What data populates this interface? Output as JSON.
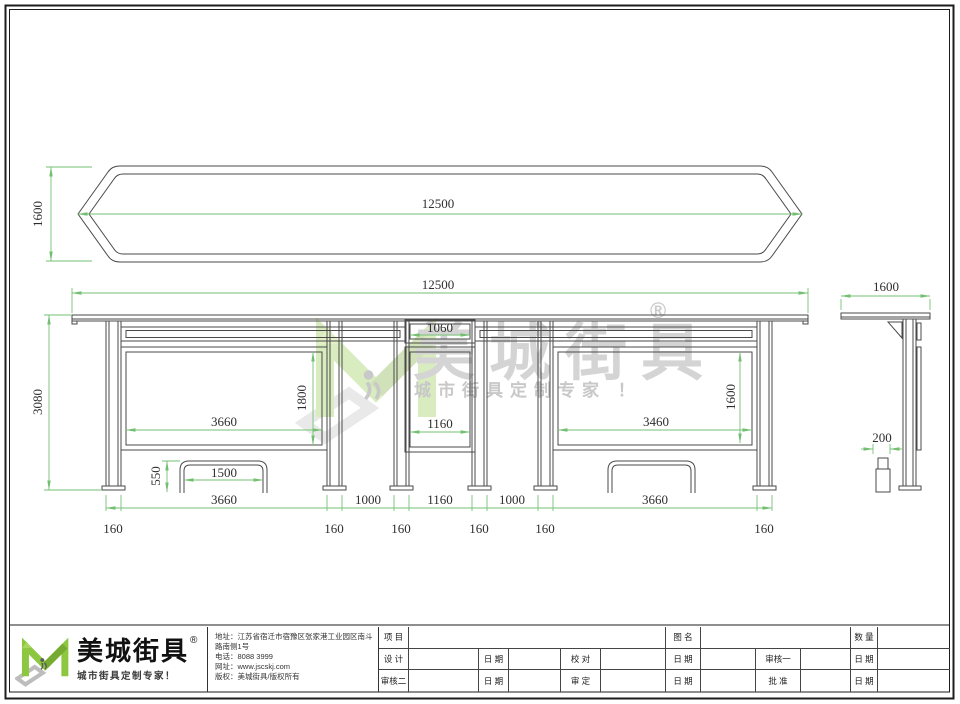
{
  "watermark": {
    "brand": "美城街具",
    "registered": "®",
    "tagline": "城市街具定制专家 ！"
  },
  "dims": {
    "overall_length": "12500",
    "overall_depth": "1600",
    "overall_height": "3080",
    "left_panel_width": "3660",
    "left_panel_height": "1800",
    "right_panel_width": "3460",
    "right_panel_height": "1600",
    "sign_header_width": "1060",
    "sign_panel_width": "1160",
    "bench_width": "1500",
    "bench_height": "550",
    "bay_gap": "1000",
    "column_width": "160",
    "bin_width": "200"
  },
  "title_block": {
    "logo": {
      "brand": "美城街具",
      "registered": "®",
      "tagline": "城市街具定制专家！"
    },
    "info": [
      "地址：江苏省宿迁市宿豫区张家港工业园区南斗路南侧1号",
      "电话：8088 3999",
      "网址：www.jscskj.com",
      "版权：美城街具/版权所有"
    ],
    "table": {
      "r1c1": "项 目",
      "r1c2": "图 名",
      "r1c3": "数 量",
      "r2": [
        "设 计",
        "日 期",
        "校 对",
        "日 期",
        "审核一",
        "日 期"
      ],
      "r3": [
        "审核二",
        "日 期",
        "审 定",
        "日 期",
        "批 准",
        "日 期"
      ]
    }
  }
}
